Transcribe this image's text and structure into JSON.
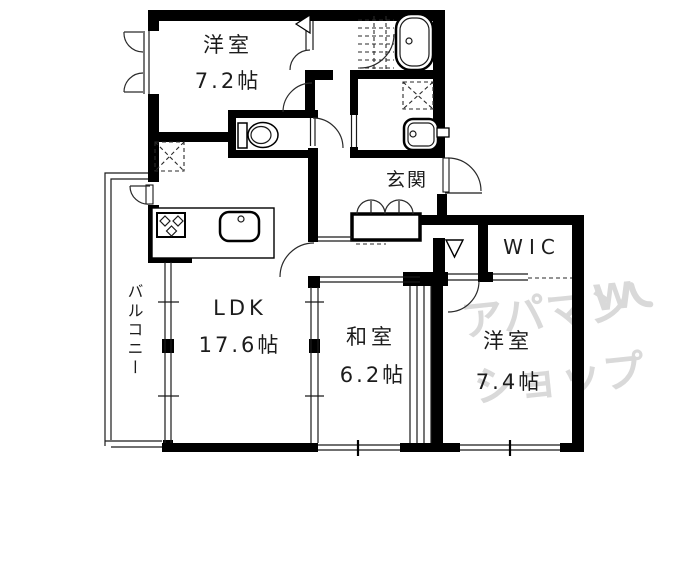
{
  "rooms": {
    "bedroom1": {
      "name": "洋室",
      "size": "7.2帖"
    },
    "ldk": {
      "name": "LDK",
      "size": "17.6帖"
    },
    "japanese_room": {
      "name": "和室",
      "size": "6.2帖"
    },
    "bedroom2": {
      "name": "洋室",
      "size": "7.4帖"
    },
    "entrance": {
      "name": "玄関"
    },
    "walk_in_closet": {
      "name": "WIC"
    },
    "balcony": {
      "name": "バルコニー"
    }
  },
  "watermark": {
    "line1": "アパマン",
    "line2": "ショップ",
    "logo": "W",
    "color": "#d9d9d9"
  },
  "colors": {
    "wall": "#000000",
    "background": "#ffffff",
    "watermark": "#d9d9d9"
  }
}
